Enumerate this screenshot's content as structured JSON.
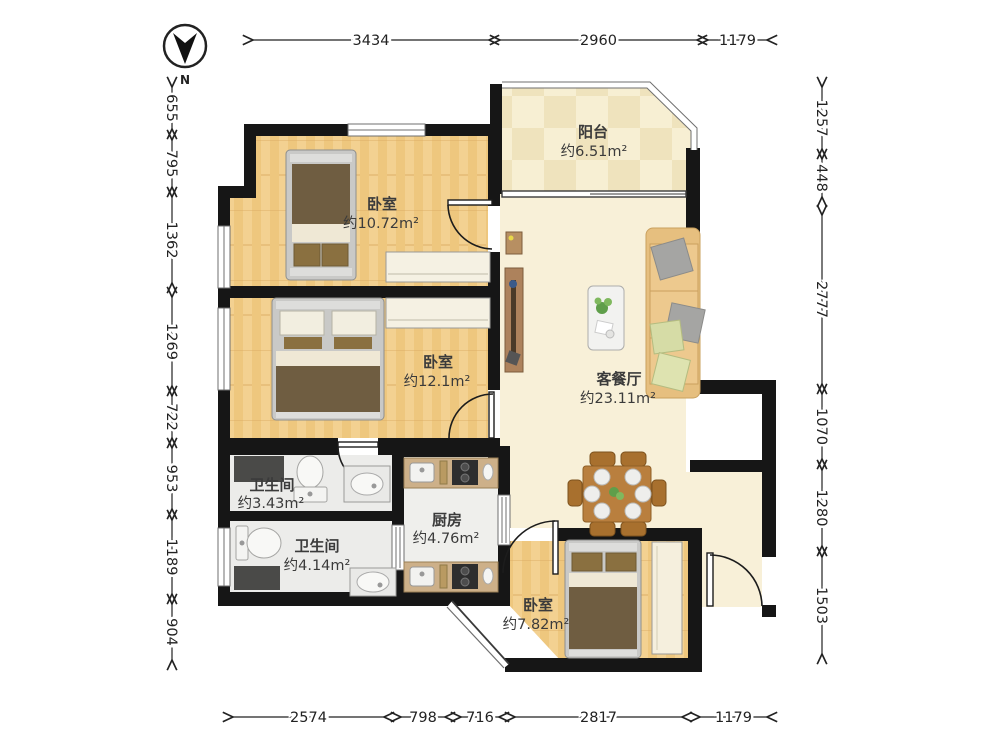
{
  "title": "apartment-floor-plan",
  "compass": {
    "label": "N"
  },
  "rooms": {
    "balcony": {
      "name": "阳台",
      "area": "约6.51m²"
    },
    "bedroom1": {
      "name": "卧室",
      "area": "约10.72m²"
    },
    "bedroom2": {
      "name": "卧室",
      "area": "约12.1m²"
    },
    "living": {
      "name": "客餐厅",
      "area": "约23.11m²"
    },
    "bath1": {
      "name": "卫生间",
      "area": "约3.43m²"
    },
    "bath2": {
      "name": "卫生间",
      "area": "约4.14m²"
    },
    "kitchen": {
      "name": "厨房",
      "area": "约4.76m²"
    },
    "bedroom3": {
      "name": "卧室",
      "area": "约7.82m²"
    }
  },
  "dimensions": {
    "top": {
      "axis": "h",
      "pos": 40,
      "segs": [
        {
          "label": "3434",
          "from": 250,
          "to": 492
        },
        {
          "label": "2960",
          "from": 497,
          "to": 700
        },
        {
          "label": "1179",
          "from": 705,
          "to": 770
        }
      ]
    },
    "bottom": {
      "axis": "h",
      "pos": 717,
      "segs": [
        {
          "label": "2574",
          "from": 230,
          "to": 387
        },
        {
          "label": "798",
          "from": 398,
          "to": 448
        },
        {
          "label": "716",
          "from": 458,
          "to": 502
        },
        {
          "label": "2817",
          "from": 512,
          "to": 685
        },
        {
          "label": "1179",
          "from": 697,
          "to": 770
        }
      ]
    },
    "left": {
      "axis": "v",
      "pos": 172,
      "segs": [
        {
          "label": "655",
          "from": 84,
          "to": 132
        },
        {
          "label": "795",
          "from": 137,
          "to": 190
        },
        {
          "label": "1362",
          "from": 194,
          "to": 286
        },
        {
          "label": "1269",
          "from": 294,
          "to": 389
        },
        {
          "label": "722",
          "from": 393,
          "to": 441
        },
        {
          "label": "953",
          "from": 445,
          "to": 512
        },
        {
          "label": "1189",
          "from": 517,
          "to": 597
        },
        {
          "label": "904",
          "from": 601,
          "to": 663
        }
      ]
    },
    "right": {
      "axis": "v",
      "pos": 822,
      "segs": [
        {
          "label": "1257",
          "from": 84,
          "to": 152
        },
        {
          "label": "448",
          "from": 156,
          "to": 200
        },
        {
          "label": "2777",
          "from": 212,
          "to": 387
        },
        {
          "label": "1070",
          "from": 391,
          "to": 462
        },
        {
          "label": "1280",
          "from": 467,
          "to": 549
        },
        {
          "label": "1503",
          "from": 554,
          "to": 657
        }
      ]
    }
  },
  "colors": {
    "wall": "#161616",
    "wood_floor": "#f3d191",
    "balcony_tile": "#f5ead0",
    "marble_floor": "#f8f0d8",
    "bath_floor": "#ececea",
    "counter": "#cdb089",
    "bed_blanket": "#6f5d41",
    "sofa": "#edc98e",
    "dining_wood": "#b97f3e"
  }
}
